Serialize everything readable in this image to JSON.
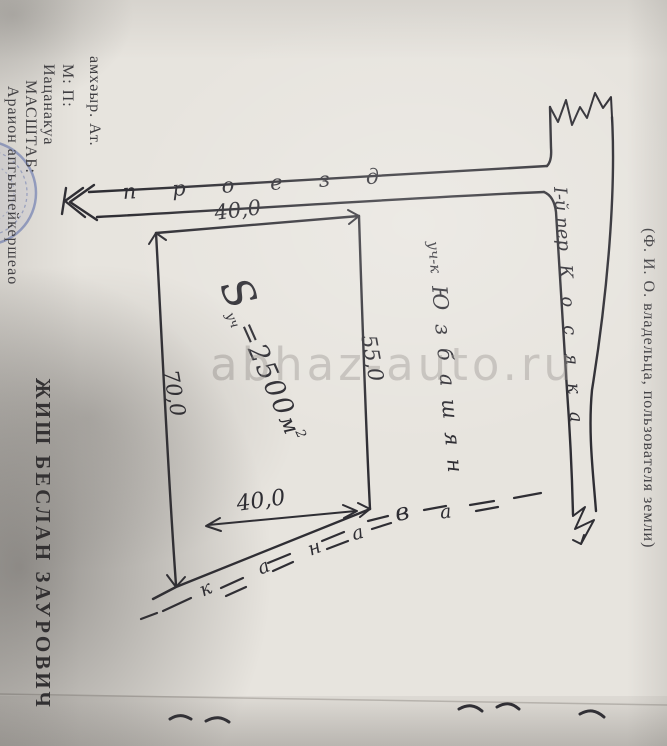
{
  "form": {
    "left_lines": [
      "амхәыр.   Ат.",
      "М:   П:",
      "Иацанакуа",
      "МАСШТАБ:",
      "Араион апгьыпейкершеао"
    ],
    "owner_name": "ЖИШ  БЕСЛАН  ЗАУРОВИЧ",
    "owner_caption": "(Ф. И. О. владельца, пользователя земли)"
  },
  "diagram": {
    "road_label": "проезд",
    "lane_prefix": "I-й пер",
    "lane_name": "Косяка",
    "plot_prefix": "уч-к",
    "plot_name": "Юзбашян",
    "area": {
      "symbol": "S",
      "subscript": "уч",
      "equals_value": "=2500",
      "unit": "м",
      "exponent": "2"
    },
    "dimensions": {
      "top": "40,0",
      "right": "55,0",
      "left": "70,0",
      "bottom": "40,0"
    },
    "ditch_letters": [
      "к",
      "а",
      "н",
      "а",
      "в",
      "а"
    ]
  },
  "watermark": {
    "text": "abhaz-auto.ru"
  },
  "colors": {
    "ink": "#2f2e34",
    "stamp_blue": "#5569af",
    "paper": "#e7e4de"
  }
}
